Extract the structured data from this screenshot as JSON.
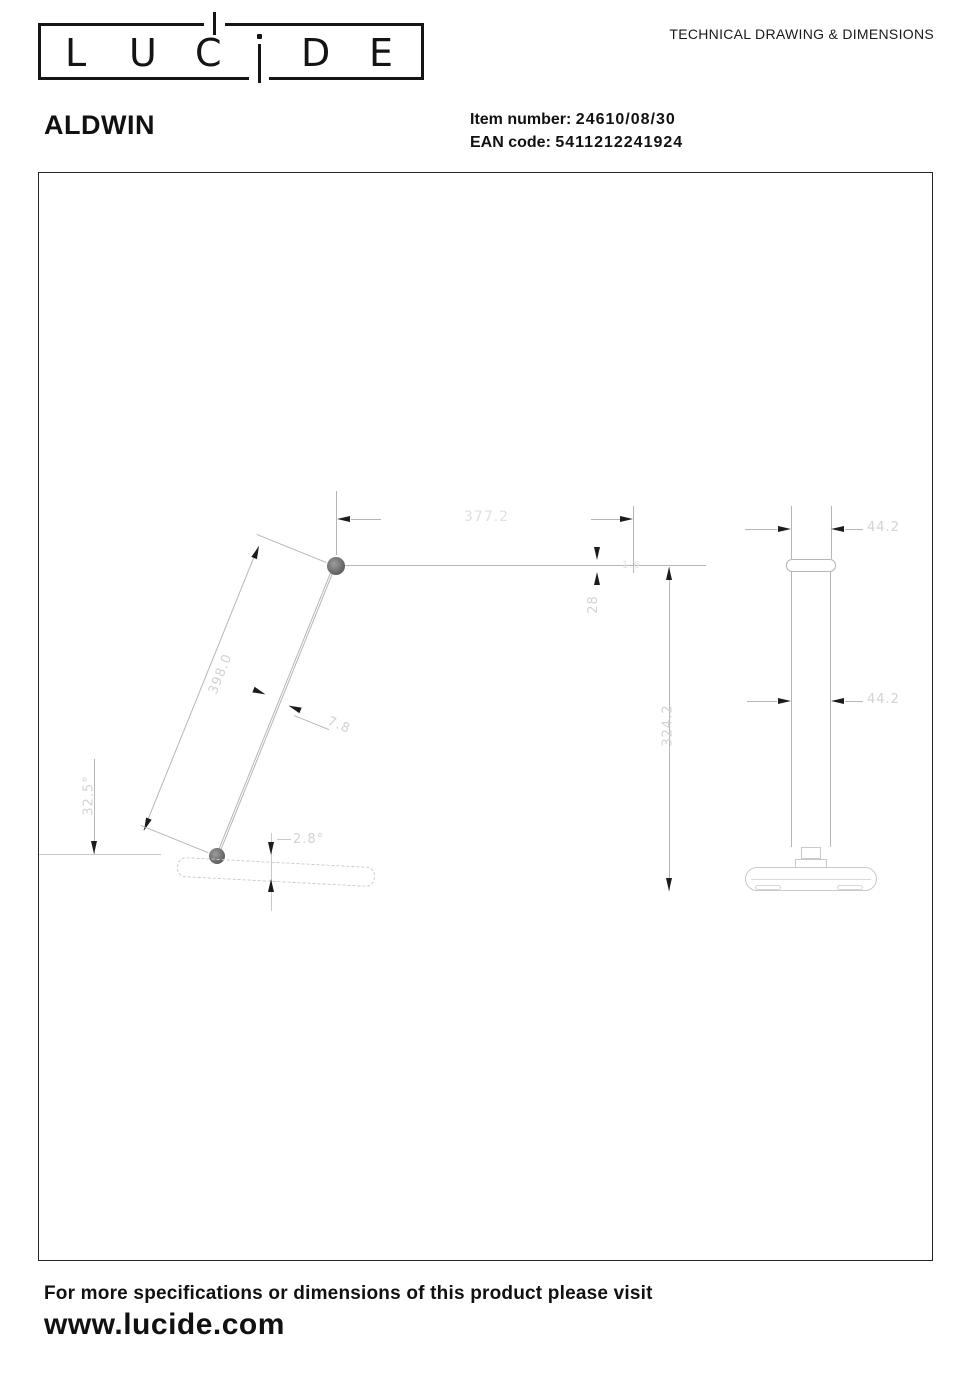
{
  "header": {
    "logo": {
      "letters": [
        "L",
        "U",
        "C",
        "i",
        "D",
        "E"
      ]
    },
    "doc_type": "TECHNICAL DRAWING & DIMENSIONS"
  },
  "product": {
    "name": "ALDWIN",
    "item_number_label": "Item number:",
    "item_number_value": "24610/08/30",
    "ean_label": "EAN code:",
    "ean_value": "5411212241924"
  },
  "drawing": {
    "side_view": {
      "arm_length": "398.0",
      "arm_reach": "377.2",
      "arm_diameter": "7.8",
      "arm_drop": "28",
      "joint_detail": "1.6",
      "total_height": "324.2",
      "base_tilt": "2.8°",
      "base_angle": "32.5°"
    },
    "front_view": {
      "head_width": "44.2",
      "body_width": "44.2"
    }
  },
  "footer": {
    "note": "For more specifications or dimensions of this product please visit",
    "website": "www.lucide.com"
  }
}
